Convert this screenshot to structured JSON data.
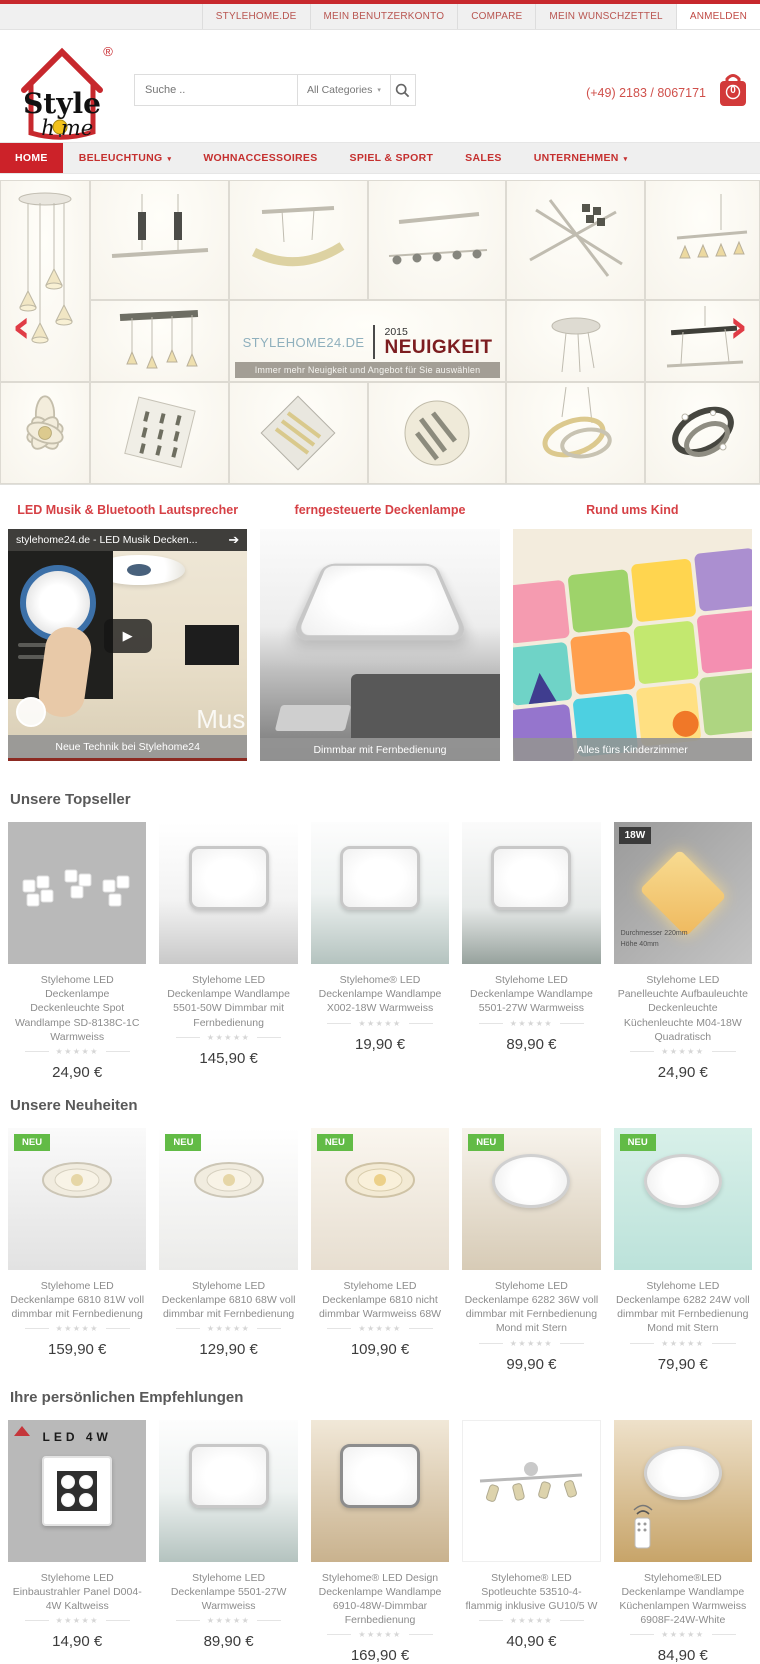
{
  "ui": {
    "stars": "★★★★★",
    "prev_arrow": "‹",
    "next_arrow": "›",
    "play": "▶",
    "chevron": "▾",
    "share_arrow": "➔"
  },
  "colors": {
    "accent": "#cc2229",
    "topline": "#c7282d",
    "badge_new": "#62bb46",
    "promo_title": "#d64045",
    "price_text": "#3c3c3c"
  },
  "topbar": {
    "items": [
      "STYLEHOME.DE",
      "MEIN BENUTZERKONTO",
      "COMPARE",
      "MEIN WUNSCHZETTEL",
      "ANMELDEN"
    ]
  },
  "header": {
    "logo": {
      "line1": "Style",
      "line2_left": "h",
      "line2_right": "me",
      "registered": "®"
    },
    "search": {
      "placeholder": "Suche ..",
      "category": "All Categories"
    },
    "phone": "(+49) 2183 / 8067171",
    "cart_count": "0"
  },
  "nav": {
    "items": [
      {
        "label": "HOME",
        "active": true
      },
      {
        "label": "BELEUCHTUNG",
        "has_dropdown": true
      },
      {
        "label": "WOHNACCESSOIRES"
      },
      {
        "label": "SPIEL & SPORT"
      },
      {
        "label": "SALES"
      },
      {
        "label": "UNTERNEHMEN",
        "has_dropdown": true
      }
    ]
  },
  "hero": {
    "brand": "STYLEHOME24.DE",
    "year": "2015",
    "headline": "NEUIGKEIT",
    "tagline": "Immer mehr Neuigkeit und Angebot für Sie auswählen"
  },
  "promos": [
    {
      "title": "LED Musik & Bluetooth Lautsprecher",
      "caption": "Neue Technik bei Stylehome24",
      "video_title": "stylehome24.de - LED Musik Decken...",
      "watermark": "Mus"
    },
    {
      "title": "ferngesteuerte Deckenlampe",
      "caption": "Dimmbar mit Fernbedienung"
    },
    {
      "title": "Rund ums Kind",
      "caption": "Alles fürs Kinderzimmer"
    }
  ],
  "sections": [
    {
      "title": "Unsere Topseller",
      "products": [
        {
          "name": "Stylehome LED Deckenlampe Deckenleuchte Spot Wandlampe SD-8138C-1C Warmweiss",
          "price": "24,90 €"
        },
        {
          "name": "Stylehome LED Deckenlampe Wandlampe 5501-50W Dimmbar mit Fernbedienung",
          "price": "145,90 €"
        },
        {
          "name": "Stylehome® LED Deckenlampe Wandlampe X002-18W Warmweiss",
          "price": "19,90 €"
        },
        {
          "name": "Stylehome LED Deckenlampe Wandlampe 5501-27W Warmweiss",
          "price": "89,90 €"
        },
        {
          "name": "Stylehome LED Panelleuchte Aufbauleuchte Deckenleuchte Küchenleuchte M04-18W Quadratisch",
          "price": "24,90 €",
          "wattage_label": "18W",
          "dim_labels": [
            "Durchmesser 220mm",
            "Höhe 40mm"
          ]
        }
      ]
    },
    {
      "title": "Unsere Neuheiten",
      "products": [
        {
          "name": "Stylehome LED Deckenlampe 6810 81W voll dimmbar mit Fernbedienung",
          "price": "159,90 €",
          "badge": "NEU"
        },
        {
          "name": "Stylehome LED Deckenlampe 6810 68W voll dimmbar mit Fernbedienung",
          "price": "129,90 €",
          "badge": "NEU"
        },
        {
          "name": "Stylehome LED Deckenlampe 6810 nicht dimmbar Warmweiss 68W",
          "price": "109,90 €",
          "badge": "NEU"
        },
        {
          "name": "Stylehome LED Deckenlampe 6282 36W voll dimmbar mit Fernbedienung Mond mit Stern",
          "price": "99,90 €",
          "badge": "NEU"
        },
        {
          "name": "Stylehome LED Deckenlampe 6282 24W voll dimmbar mit Fernbedienung Mond mit Stern",
          "price": "79,90 €",
          "badge": "NEU"
        }
      ]
    },
    {
      "title": "Ihre persönlichen Empfehlungen",
      "products": [
        {
          "name": "Stylehome LED Einbaustrahler Panel D004-4W Kaltweiss",
          "price": "14,90 €",
          "image_label": "LED 4W"
        },
        {
          "name": "Stylehome LED Deckenlampe 5501-27W Warmweiss",
          "price": "89,90 €"
        },
        {
          "name": "Stylehome® LED Design Deckenlampe Wandlampe 6910-48W-Dimmbar Fernbedienung",
          "price": "169,90 €"
        },
        {
          "name": "Stylehome® LED Spotleuchte 53510-4-flammig inklusive GU10/5 W",
          "price": "40,90 €"
        },
        {
          "name": "Stylehome®LED Deckenlampe Wandlampe Küchenlampen Warmweiss 6908F-24W-White",
          "price": "84,90 €"
        }
      ]
    }
  ]
}
